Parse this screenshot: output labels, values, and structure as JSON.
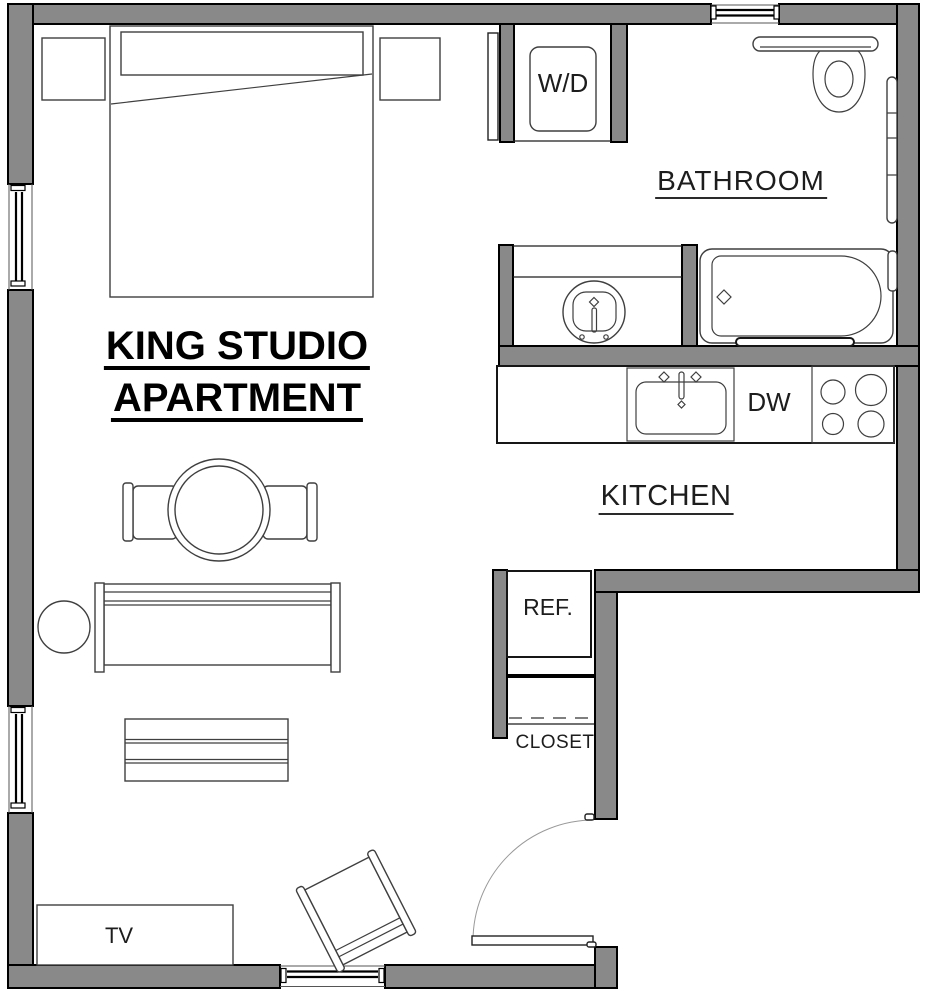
{
  "title": {
    "line1": "KING STUDIO",
    "line2": "APARTMENT"
  },
  "room_labels": {
    "bathroom": "BATHROOM",
    "kitchen": "KITCHEN"
  },
  "fixture_labels": {
    "washer_dryer": "W/D",
    "dishwasher": "DW",
    "refrigerator": "REF.",
    "closet": "CLOSET",
    "tv": "TV"
  },
  "colors": {
    "wall_fill": "#898989",
    "wall_outline": "#000000",
    "line_color": "#3f3f3f",
    "background": "#ffffff"
  }
}
